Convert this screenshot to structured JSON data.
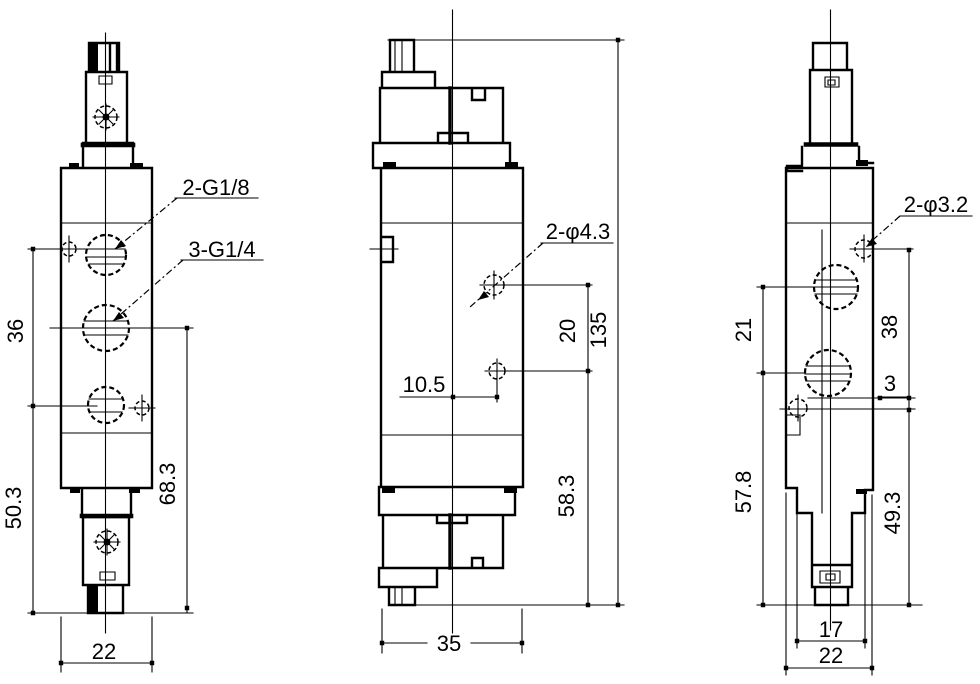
{
  "drawing": {
    "type": "solenoid-valve-3-view-dimension-drawing",
    "colors": {
      "ink": "#000000",
      "paper": "#ffffff"
    },
    "views": {
      "front": {
        "labels": {
          "upper_ports": "2-G1/8",
          "middle_port": "3-G1/4"
        },
        "dims": {
          "port_spacing": "36",
          "lower_section": "50.3",
          "port_to_base": "68.3",
          "width": "22"
        }
      },
      "side": {
        "labels": {
          "mount_holes": "2-φ4.3"
        },
        "dims": {
          "hole_x_offset": "10.5",
          "hole_spacing": "20",
          "total_height": "135",
          "lower_height": "58.3",
          "depth": "35"
        }
      },
      "back": {
        "labels": {
          "pilot_holes": "2-φ3.2"
        },
        "dims": {
          "upper_span": "21",
          "hole_spacing": "38",
          "hole_offset": "3",
          "body_height": "57.8",
          "hole_to_base": "49.3",
          "inner_width": "17",
          "width": "22"
        }
      }
    }
  }
}
